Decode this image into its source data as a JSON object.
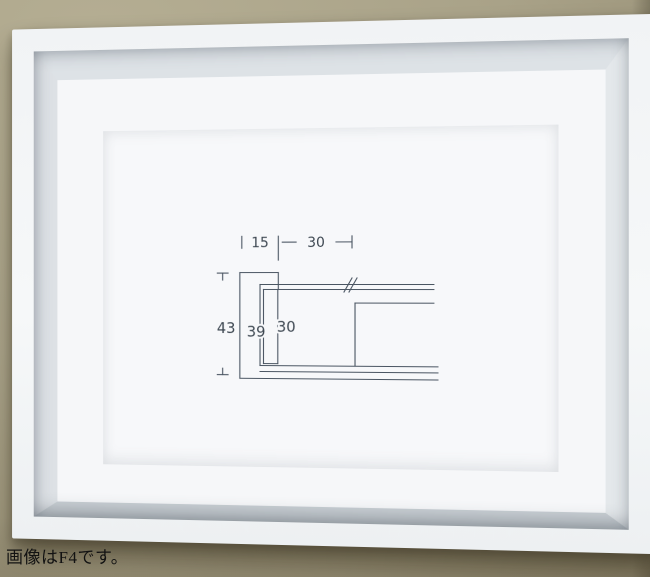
{
  "scene": {
    "description": "White box picture frame hanging on a tan wall; inside, a paper with a dimensioned cross-section drawing of the frame moulding",
    "wall_color": "#a9a288",
    "frame_color": "#f4f6f7",
    "cavity_wall_color": "#dde2e6",
    "paper_color": "#f7f8fa"
  },
  "caption": {
    "text": "画像はF4です。",
    "color": "#121212"
  },
  "diagram": {
    "type": "frame-moulding-cross-section",
    "line_color": "#4a5562",
    "label_color": "#3e4852",
    "dimensions": {
      "top": [
        {
          "label": "15"
        },
        {
          "label": "30"
        }
      ],
      "side": [
        {
          "label": "43"
        },
        {
          "label": "39"
        },
        {
          "label": "30"
        }
      ]
    }
  }
}
